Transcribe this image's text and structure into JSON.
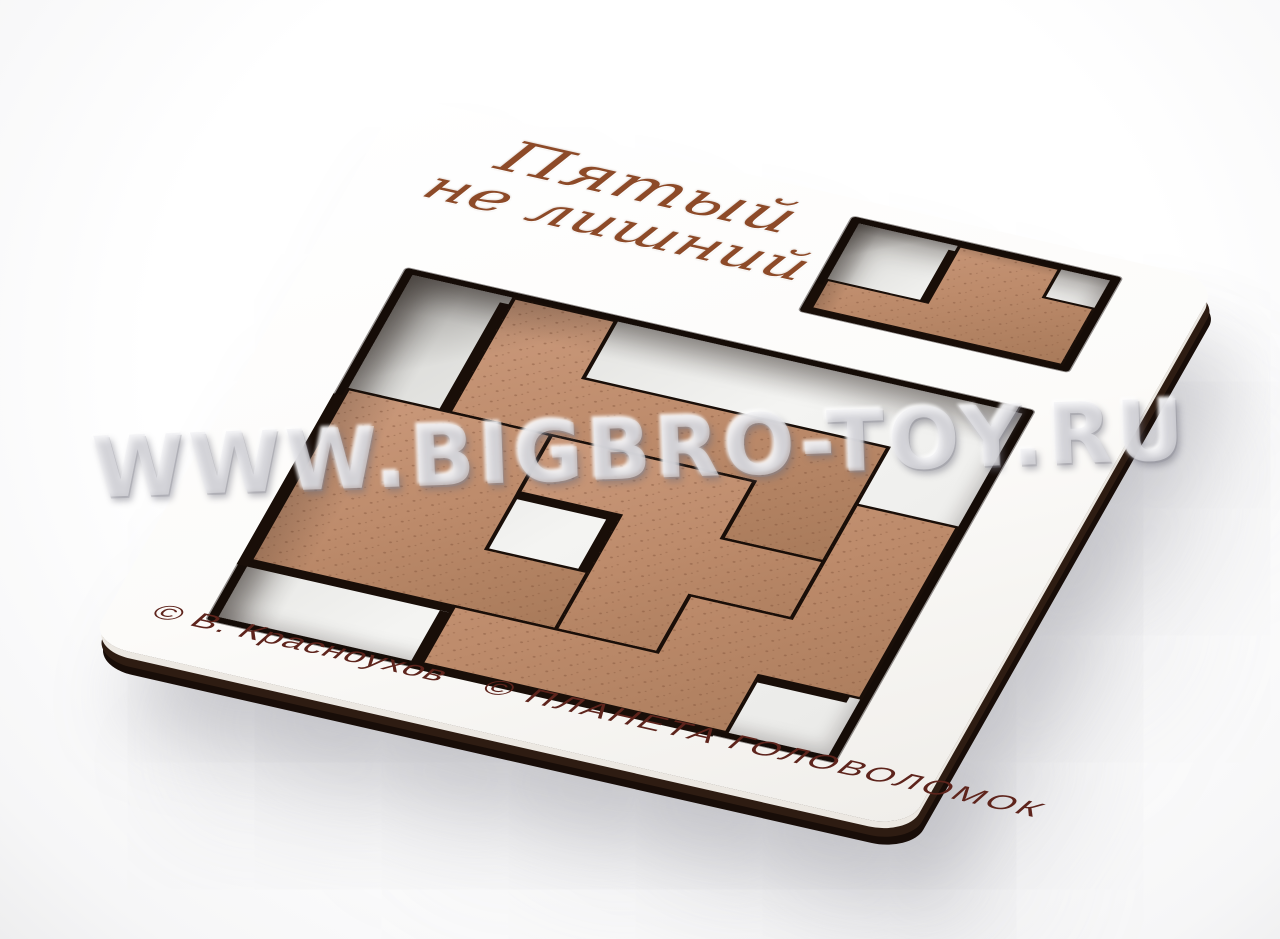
{
  "product": {
    "title_line1": "Пятый",
    "title_line2": "не лишний",
    "copyright_author": "© В. Красноухов",
    "copyright_company": "© ПЛАНЕТА  ГОЛОВОЛОМОК",
    "watermark": "WWW.BIGBRO-TOY.RU"
  },
  "colors": {
    "piece_light": "#cb9a7c",
    "piece_mid": "#bd8b6b",
    "piece_dark": "#a87a5a",
    "speckle": "#7e5138",
    "cut_edge": "#190e08",
    "board_white": "#ffffff",
    "tray_floor": "#f2f2ef",
    "title_brown": "#8d4a28",
    "copyright_maroon": "#5e241c"
  },
  "puzzle": {
    "big_tray": {
      "cols": 6,
      "rows": 6,
      "cell": 77,
      "stroke": 3,
      "side_offset": [
        -8,
        9
      ],
      "pieces": [
        {
          "id": "piece-top-n",
          "points": [
            [
              1,
              0
            ],
            [
              2,
              0
            ],
            [
              2,
              1
            ],
            [
              5,
              1
            ],
            [
              5,
              3
            ],
            [
              4,
              3
            ],
            [
              4,
              2
            ],
            [
              1,
              2
            ]
          ]
        },
        {
          "id": "piece-left-p",
          "points": [
            [
              0,
              2
            ],
            [
              2,
              2
            ],
            [
              2,
              4
            ],
            [
              3,
              4
            ],
            [
              3,
              5
            ],
            [
              0,
              5
            ]
          ]
        },
        {
          "id": "piece-center-z",
          "points": [
            [
              2,
              2
            ],
            [
              4,
              2
            ],
            [
              4,
              3
            ],
            [
              5,
              3
            ],
            [
              5,
              4
            ],
            [
              4,
              4
            ],
            [
              4,
              5
            ],
            [
              3,
              5
            ],
            [
              3,
              3
            ],
            [
              2,
              3
            ]
          ]
        },
        {
          "id": "piece-right-l",
          "points": [
            [
              5,
              2
            ],
            [
              6,
              2
            ],
            [
              6,
              5
            ],
            [
              5,
              5
            ],
            [
              5,
              6
            ],
            [
              2,
              6
            ],
            [
              2,
              5
            ],
            [
              4,
              5
            ],
            [
              4,
              4
            ],
            [
              5,
              4
            ]
          ]
        }
      ]
    },
    "small_tray": {
      "cols": 5,
      "rows": 3,
      "cell": 38,
      "stroke": 2.5,
      "side_offset": [
        -6,
        7
      ],
      "pieces": [
        {
          "id": "piece-fifth",
          "points": [
            [
              2,
              0
            ],
            [
              4,
              0
            ],
            [
              4,
              1
            ],
            [
              5,
              1
            ],
            [
              5,
              3
            ],
            [
              0,
              3
            ],
            [
              0,
              2
            ],
            [
              2,
              2
            ]
          ]
        }
      ]
    }
  }
}
